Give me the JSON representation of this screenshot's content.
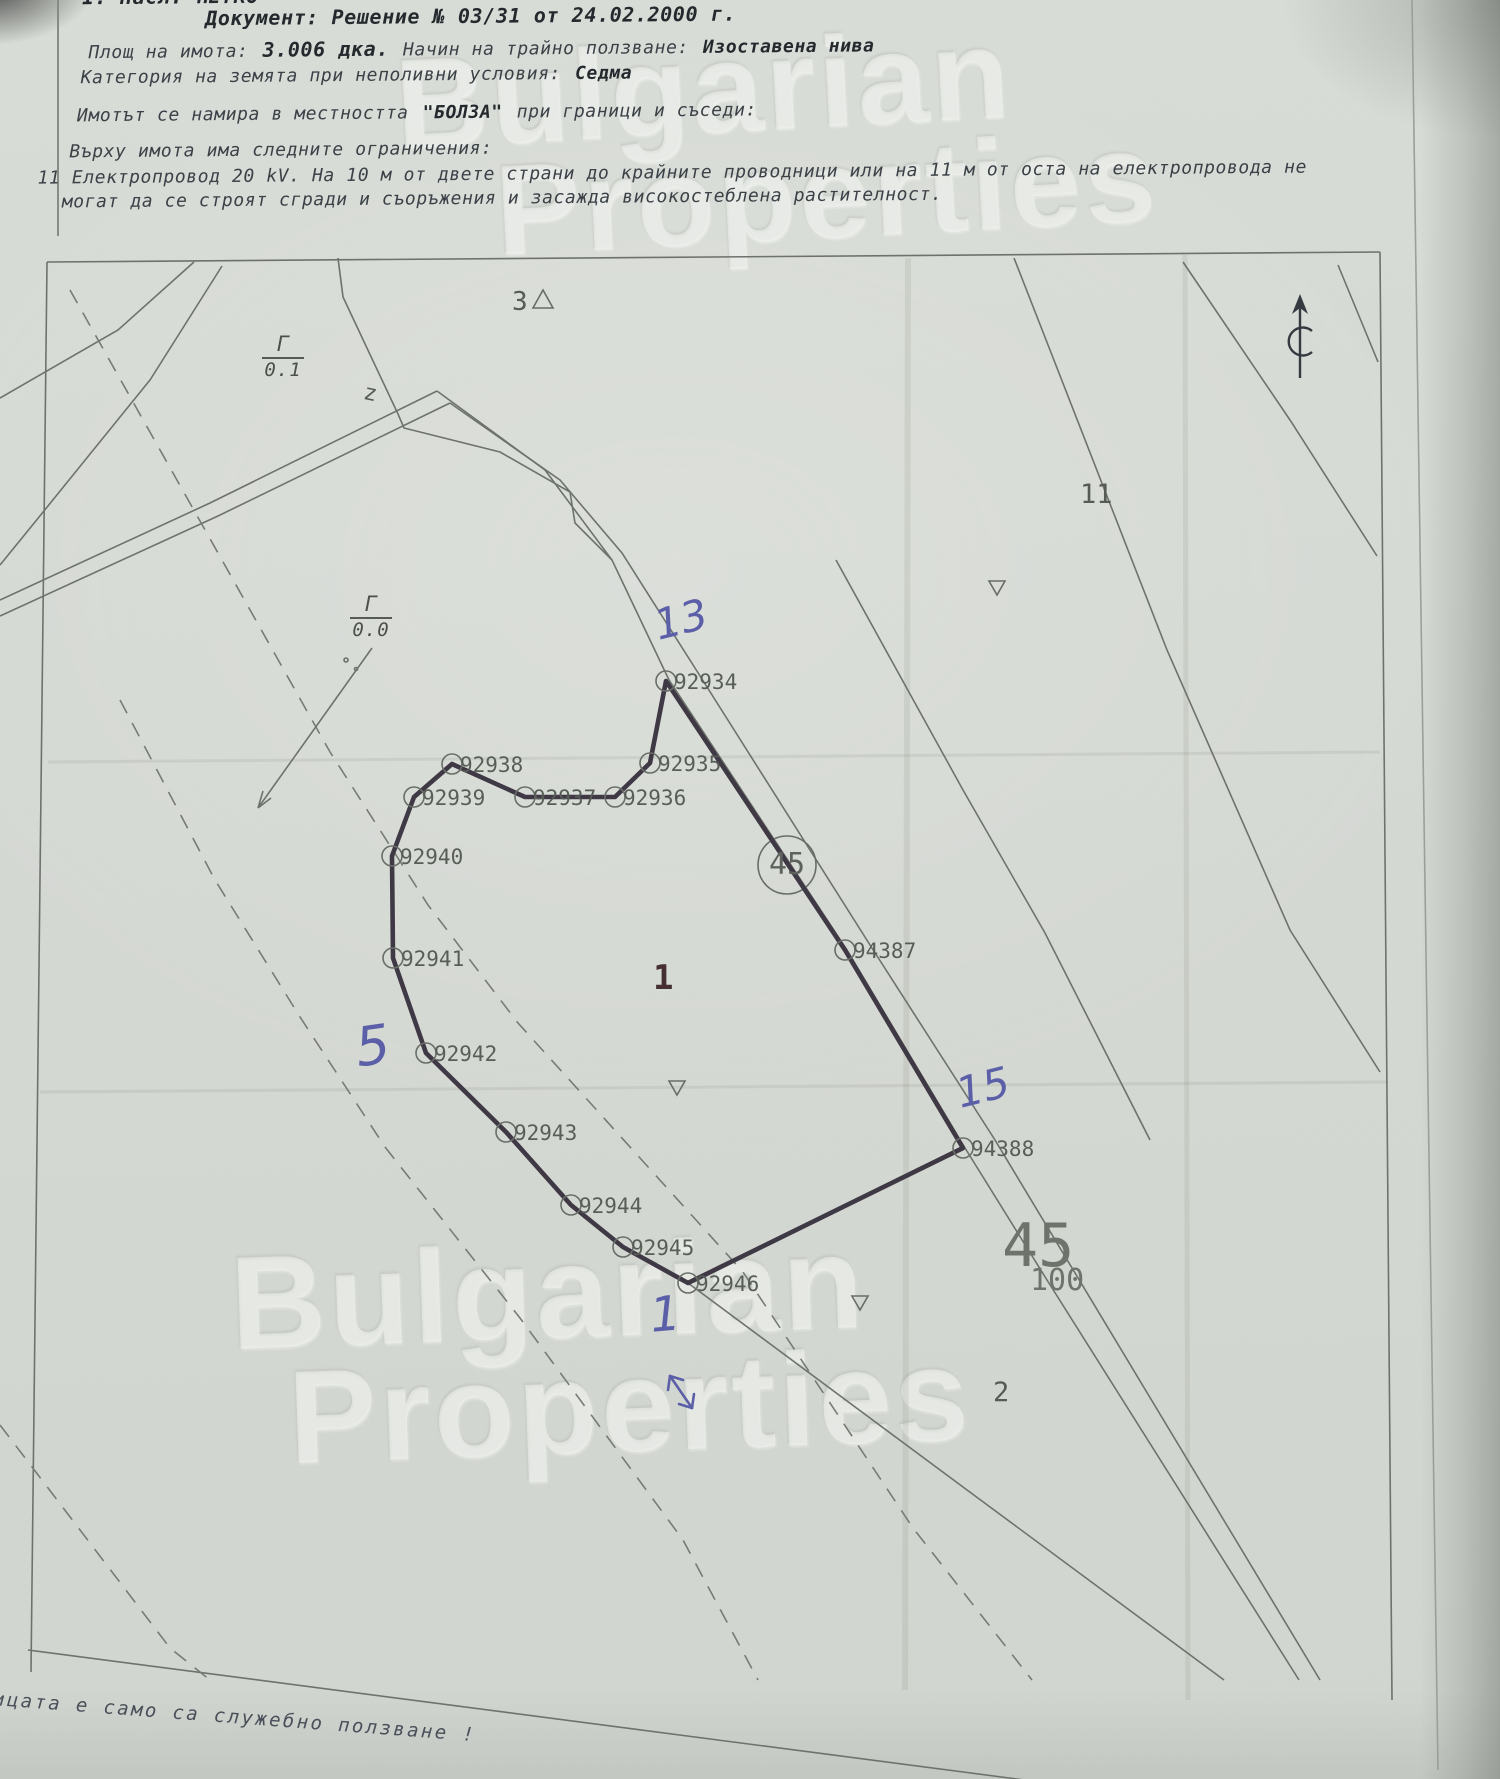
{
  "document": {
    "line1": "1. Насл. ПЕТКО",
    "line2": "Документ: Решение № 03/31 от 24.02.2000 г.",
    "line3a": "Площ на имота:",
    "line3b": "3.006 дка.",
    "line3c": "Начин на трайно ползване:",
    "line3d": "Изоставена нива",
    "line4a": "Категория на земята при неполивни условия:",
    "line4b": "Седма",
    "line5a": "Имотът се намира в местността",
    "line5b": "\"БОЛЗА\"",
    "line5c": "при граници и съседи:",
    "line6": "Върху имота има следните ограничения:",
    "line7": "11 Електропровод 20 kV. На 10 м от двете страни до крайните проводници или на 11 м от оста на електропровода не",
    "line8": "могат да се строят сгради и съоръжения и засажда високостеблена растителност.",
    "footer": "ицата е само са служебно ползване !"
  },
  "watermark": {
    "line1": "Bulgarian",
    "line2": "Properties"
  },
  "colors": {
    "paper": "#d5d9d3",
    "map_line": "#6d736c",
    "boundary": "#3f3845",
    "pen_blue": "#5b5fa8",
    "typewriter": "#3b4147"
  },
  "map": {
    "parcel_number_label": "1",
    "road_parcel_number": "45",
    "sheet_number": "45",
    "sheet_sub_number": "100",
    "north_symbol": "north-arrow",
    "points": [
      {
        "id": "92934",
        "x": 666,
        "y": 681
      },
      {
        "id": "92935",
        "x": 650,
        "y": 763
      },
      {
        "id": "92936",
        "x": 615,
        "y": 797
      },
      {
        "id": "92937",
        "x": 525,
        "y": 797
      },
      {
        "id": "92938",
        "x": 452,
        "y": 764
      },
      {
        "id": "92939",
        "x": 414,
        "y": 797
      },
      {
        "id": "92940",
        "x": 392,
        "y": 856
      },
      {
        "id": "92941",
        "x": 393,
        "y": 958
      },
      {
        "id": "92942",
        "x": 426,
        "y": 1053
      },
      {
        "id": "92943",
        "x": 506,
        "y": 1132
      },
      {
        "id": "92944",
        "x": 571,
        "y": 1205
      },
      {
        "id": "92945",
        "x": 623,
        "y": 1247
      },
      {
        "id": "92946",
        "x": 688,
        "y": 1283
      },
      {
        "id": "94388",
        "x": 963,
        "y": 1148
      },
      {
        "id": "94387",
        "x": 845,
        "y": 950
      }
    ],
    "boundary": [
      "92934",
      "92935",
      "92936",
      "92937",
      "92938",
      "92939",
      "92940",
      "92941",
      "92942",
      "92943",
      "92944",
      "92945",
      "92946",
      "94388",
      "94387"
    ],
    "labels": [
      {
        "name": "neighbor-parcel-3",
        "text": "3",
        "x": 512,
        "y": 289,
        "size": 26,
        "color": "#565c55",
        "rot": 0,
        "bold": false,
        "hand": false
      },
      {
        "name": "neighbor-parcel-11",
        "text": "11",
        "x": 1080,
        "y": 481,
        "size": 27,
        "color": "#565c55",
        "rot": 0,
        "bold": false,
        "hand": false
      },
      {
        "name": "parcel-number",
        "text": "1",
        "x": 653,
        "y": 961,
        "size": 34,
        "color": "#452f33",
        "rot": 0,
        "bold": true,
        "hand": false
      },
      {
        "name": "neighbor-parcel-2",
        "text": "2",
        "x": 993,
        "y": 1379,
        "size": 27,
        "color": "#565c55",
        "rot": 0,
        "bold": false,
        "hand": false
      },
      {
        "name": "map-sheet-number",
        "text": "45",
        "x": 1002,
        "y": 1216,
        "size": 60,
        "color": "#6e746c",
        "rot": 0,
        "bold": false,
        "hand": false
      },
      {
        "name": "map-sheet-sub-number",
        "text": "100",
        "x": 1030,
        "y": 1266,
        "size": 30,
        "color": "#6e746c",
        "rot": 0,
        "bold": false,
        "hand": false
      },
      {
        "name": "road-parcel-number",
        "text": "45",
        "x": 769,
        "y": 850,
        "size": 30,
        "color": "#5d635c",
        "rot": 0,
        "bold": false,
        "hand": false
      },
      {
        "name": "road-z-mark",
        "text": "z",
        "x": 366,
        "y": 382,
        "size": 22,
        "color": "#565c55",
        "rot": 12,
        "bold": false,
        "hand": false
      },
      {
        "name": "pen-note-13",
        "text": "13",
        "x": 650,
        "y": 606,
        "size": 42,
        "color": "#5b5fa8",
        "rot": -14,
        "bold": false,
        "hand": true
      },
      {
        "name": "pen-note-5",
        "text": "5",
        "x": 352,
        "y": 1022,
        "size": 54,
        "color": "#5b5fa8",
        "rot": -8,
        "bold": false,
        "hand": true
      },
      {
        "name": "pen-note-15",
        "text": "15",
        "x": 952,
        "y": 1074,
        "size": 42,
        "color": "#5b5fa8",
        "rot": -14,
        "bold": false,
        "hand": true
      },
      {
        "name": "pen-note-1",
        "text": "1",
        "x": 648,
        "y": 1292,
        "size": 48,
        "color": "#5b5fa8",
        "rot": -5,
        "bold": false,
        "hand": true
      }
    ],
    "fractions": [
      {
        "name": "landuse-fraction-0-1",
        "top": "Г",
        "bottom": "0.1",
        "x": 260,
        "y": 334
      },
      {
        "name": "landuse-fraction-0-0",
        "top": "Г",
        "bottom": "0.0",
        "x": 348,
        "y": 594
      }
    ]
  }
}
